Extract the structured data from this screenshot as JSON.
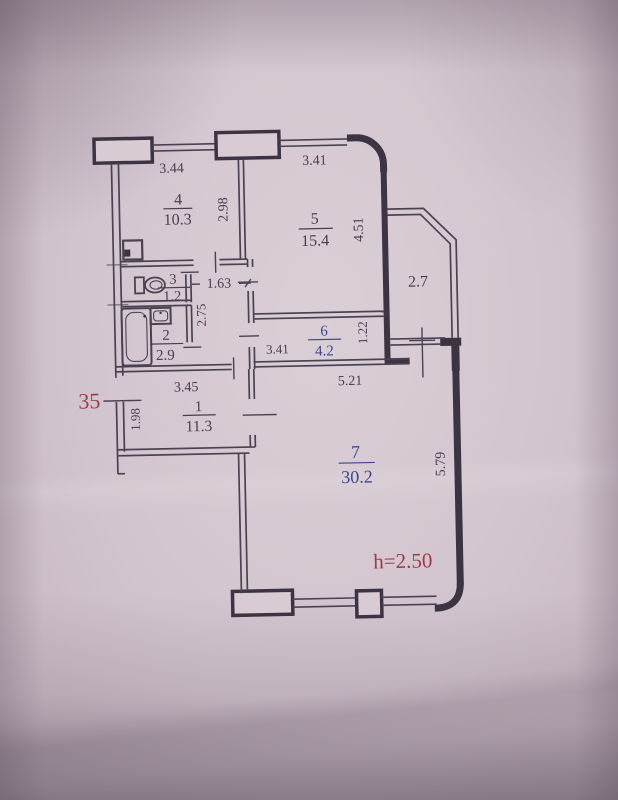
{
  "plan": {
    "apartment_number": "35",
    "height_label": "h=2.50",
    "balcony_area": "2.7",
    "rooms": [
      {
        "number": "1",
        "area": "11.3"
      },
      {
        "number": "2",
        "area": "2.9"
      },
      {
        "number": "3",
        "area": "1.2"
      },
      {
        "number": "4",
        "area": "10.3"
      },
      {
        "number": "5",
        "area": "15.4"
      },
      {
        "number": "6",
        "area": "4.2"
      },
      {
        "number": "7",
        "area": "30.2"
      }
    ],
    "dimensions": {
      "top_wall_left": "3.44",
      "top_wall_right": "3.41",
      "room4_depth": "2.98",
      "room5_depth": "4.51",
      "wc_hall_width": "1.63",
      "wc_hall_depth": "2.75",
      "room6_width": "3.41",
      "room6_depth": "1.22",
      "room7_top_width": "5.21",
      "hall_width": "3.45",
      "entry_wall": "1.98",
      "room7_right_depth": "5.79"
    },
    "colors": {
      "ink": "#3c3442",
      "blue_ink": "#3d4590",
      "red_ink": "#9e3947",
      "paper": "#d2c4ce"
    },
    "icons": [
      "toilet-icon",
      "bathtub-icon",
      "sink-icon",
      "vent-shaft-icon"
    ]
  }
}
